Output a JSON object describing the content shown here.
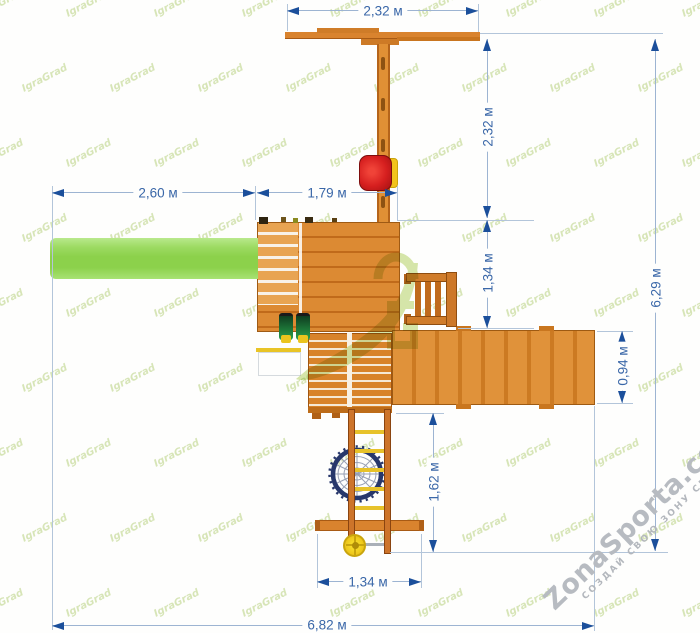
{
  "branding": {
    "tile_watermark": "IgraGrad",
    "site": "ZonaSporta.com",
    "slogan": "СОЗДАЙ СВОЮ ЗОНУ СПОРТА"
  },
  "dimensions": {
    "top_beam_width": "2,32 м",
    "swing_depth": "2,32 м",
    "slide_length": "2,60 м",
    "deck_offset": "1,79 м",
    "deck_depth": "1,34 м",
    "ramp_depth": "0,94 м",
    "total_depth": "6,29 м",
    "net_drop": "1,62 м",
    "net_beam_width": "1,34 м",
    "total_width": "6,82 м"
  },
  "colors": {
    "wood": "#d9832e",
    "wood_dark": "#a05510",
    "slide_green": "#8cd14b",
    "seat_red": "#d61f1f",
    "accent_yellow": "#eac41e",
    "net_navy": "#27376b",
    "dim_line": "#9db4d2",
    "dim_arrow": "#1b4f9b",
    "dim_text": "#3a67a8",
    "logo_green": "#b5d163"
  }
}
